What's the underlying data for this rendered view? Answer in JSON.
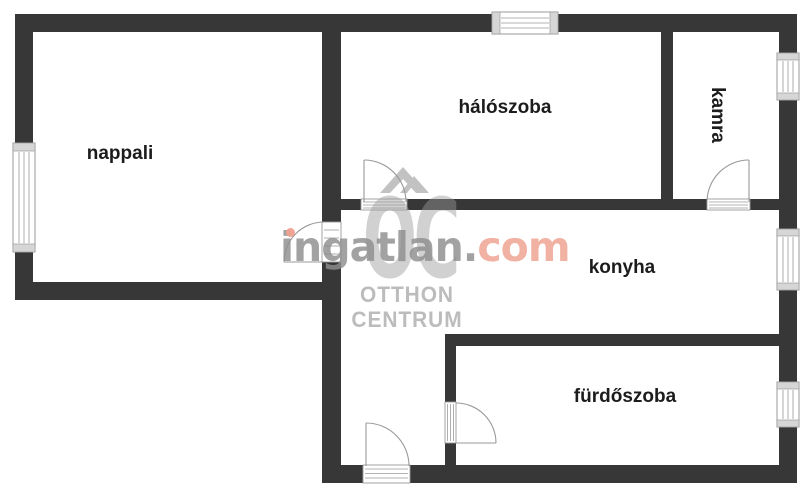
{
  "plan": {
    "rooms": [
      {
        "id": "nappali",
        "label": "nappali"
      },
      {
        "id": "haloszoba",
        "label": "hálószoba"
      },
      {
        "id": "kamra",
        "label": "kamra"
      },
      {
        "id": "konyha",
        "label": "konyha"
      },
      {
        "id": "furdoszoba",
        "label": "fürdőszoba"
      }
    ]
  },
  "watermark": {
    "brand_gray": "ingatlan.",
    "brand_accent": "com",
    "logo_letters": "OC",
    "logo_line1": "OTTHON",
    "logo_line2": "CENTRUM"
  },
  "colors": {
    "wall": "#373737",
    "room_label": "#1c1c1c",
    "watermark_gray": "#8e8e8e",
    "watermark_accent": "#efa08f",
    "logo_gray": "#9a9a9a",
    "logo_text": "#bcbcbc"
  }
}
